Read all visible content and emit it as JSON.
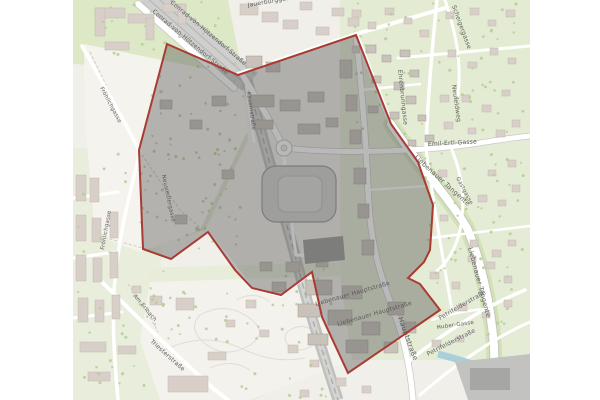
{
  "map": {
    "description": "City map with highlighted planning area polygon",
    "selection": {
      "points": "167,44 238,75 356,35 391,124 418,162 433,205 430,250 424,262 408,278 420,284 440,310 348,373 322,317 312,272 281,295 252,288 235,270 208,232 171,259 143,249 139,150",
      "fill": "rgba(80,80,80,0.40)",
      "border": "#a83b32"
    },
    "colors": {
      "base": "#f0efe9",
      "green_residential": "#e5ecd6",
      "park_green": "#dce8c6",
      "open_field": "#f5f3ee",
      "building": "#d8d0c8",
      "building_inner": "#c9c2ba",
      "road": "#ffffff",
      "road_casing": "#c9c9c7",
      "railway": "#bfbfbd",
      "water": "#a9cfdb",
      "label": "#5c5c5c"
    },
    "street_labels": [
      {
        "text": "Conrad-von-Hötzendorf-Straße",
        "x": 152,
        "y": 12,
        "rot": 40,
        "size": 6
      },
      {
        "text": "Conrad-von-Hötzendorf-Straße",
        "x": 170,
        "y": 3,
        "rot": 40,
        "size": 6
      },
      {
        "text": "Jauerburggasse",
        "x": 248,
        "y": 7,
        "rot": -10,
        "size": 6
      },
      {
        "text": "Scheigergasse",
        "x": 452,
        "y": 6,
        "rot": 70,
        "size": 6
      },
      {
        "text": "Ehrenbrunngasse",
        "x": 398,
        "y": 70,
        "rot": 84,
        "size": 6
      },
      {
        "text": "Neufeldweg",
        "x": 452,
        "y": 85,
        "rot": 82,
        "size": 6
      },
      {
        "text": "Emil-Ertl-Gasse",
        "x": 428,
        "y": 146,
        "rot": -3,
        "size": 6
      },
      {
        "text": "Liebenauer Tangente",
        "x": 414,
        "y": 158,
        "rot": 42,
        "size": 6.5
      },
      {
        "text": "Liebenauer Tangente",
        "x": 468,
        "y": 248,
        "rot": 75,
        "size": 6.5
      },
      {
        "text": "Gastgasse",
        "x": 456,
        "y": 178,
        "rot": 62,
        "size": 5.5
      },
      {
        "text": "Kasernstraße",
        "x": 247,
        "y": 92,
        "rot": 82,
        "size": 5.5
      },
      {
        "text": "Neusiedlergasse",
        "x": 162,
        "y": 175,
        "rot": 78,
        "size": 5.5
      },
      {
        "text": "Fröhlichgasse",
        "x": 100,
        "y": 88,
        "rot": 62,
        "size": 5.5
      },
      {
        "text": "Fröhlichgasse",
        "x": 104,
        "y": 250,
        "rot": -80,
        "size": 5.5
      },
      {
        "text": "Am Erlbach",
        "x": 133,
        "y": 296,
        "rot": 50,
        "size": 5.5
      },
      {
        "text": "Triesterstraße",
        "x": 150,
        "y": 342,
        "rot": 42,
        "size": 6
      },
      {
        "text": "Liebenauer Hauptstraße",
        "x": 316,
        "y": 306,
        "rot": -16,
        "size": 6
      },
      {
        "text": "Liebenauer Hauptstraße",
        "x": 338,
        "y": 326,
        "rot": -16,
        "size": 6
      },
      {
        "text": "Hauptstraße",
        "x": 398,
        "y": 318,
        "rot": 70,
        "size": 7
      },
      {
        "text": "Petrifelderstraße",
        "x": 440,
        "y": 320,
        "rot": -30,
        "size": 6
      },
      {
        "text": "Petrifelderstraße",
        "x": 428,
        "y": 356,
        "rot": -27,
        "size": 6
      },
      {
        "text": "Huber-Gasse",
        "x": 437,
        "y": 329,
        "rot": -8,
        "size": 5.5
      }
    ]
  }
}
